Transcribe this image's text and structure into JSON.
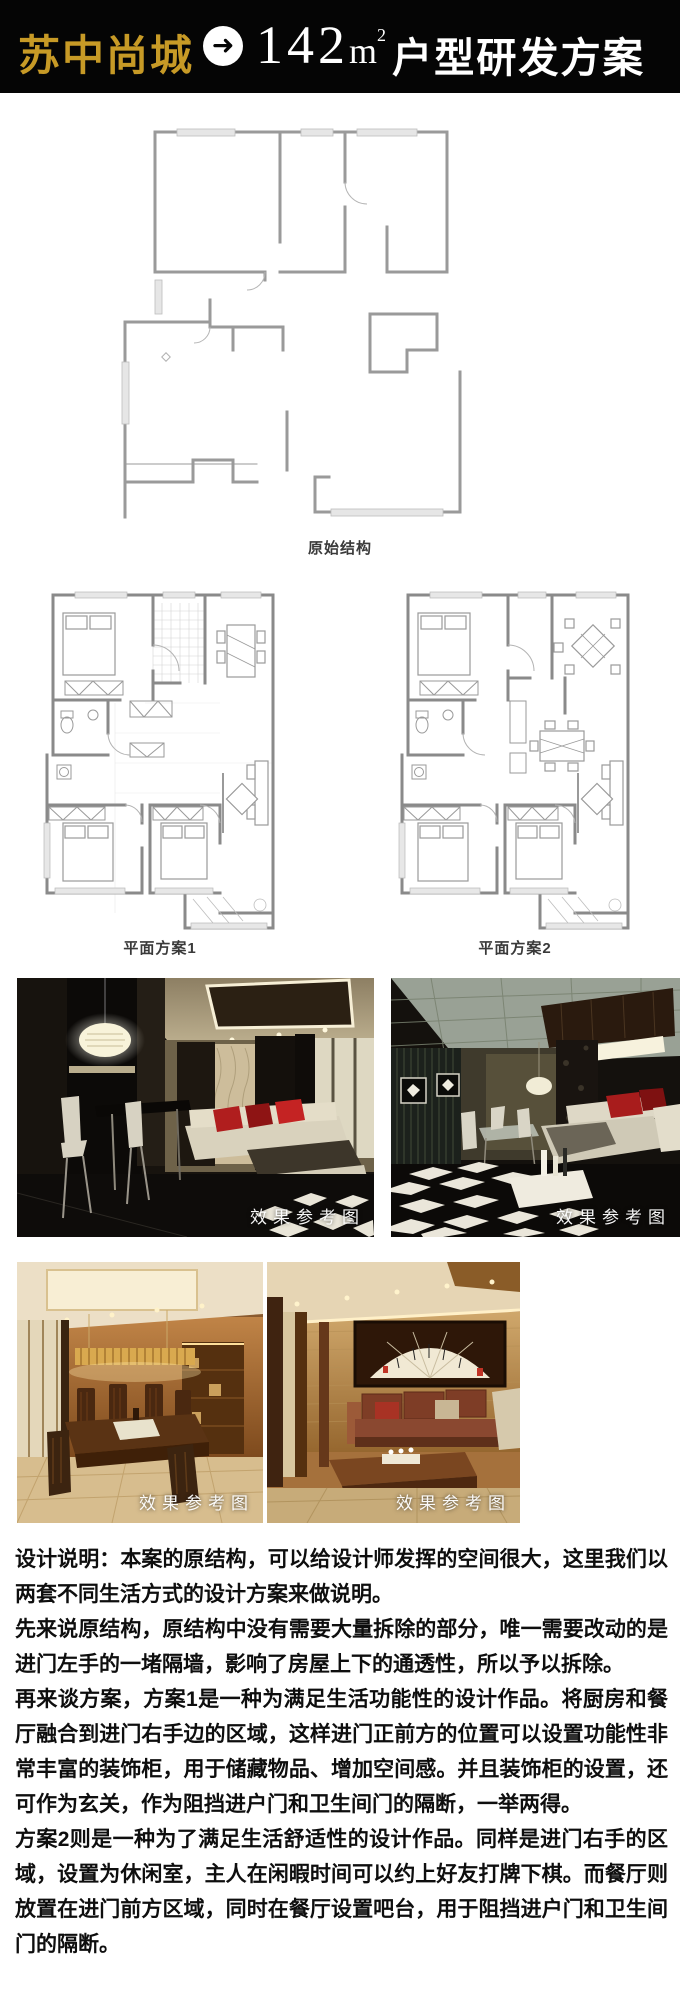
{
  "header": {
    "project_name": "苏中尚城",
    "arrow_icon": "➜",
    "area_value": "142",
    "area_unit": "m",
    "area_sup": "2",
    "title": "户型研发方案",
    "colors": {
      "background": "#050505",
      "gold": "#C79A26",
      "white": "#FFFFFF"
    }
  },
  "floor_plans": {
    "original_label": "原始结构",
    "plan1_label": "平面方案1",
    "plan2_label": "平面方案2"
  },
  "photos": {
    "watermark_label": "效果参考图",
    "accent_red": "#B01E1E",
    "warm_gold": "#C9A24F"
  },
  "design_notes": {
    "paragraphs": [
      "设计说明：本案的原结构，可以给设计师发挥的空间很大，这里我们以两套不同生活方式的设计方案来做说明。",
      "先来说原结构，原结构中没有需要大量拆除的部分，唯一需要改动的是进门左手的一堵隔墙，影响了房屋上下的通透性，所以予以拆除。",
      "再来谈方案，方案1是一种为满足生活功能性的设计作品。将厨房和餐厅融合到进门右手边的区域，这样进门正前方的位置可以设置功能性非常丰富的装饰柜，用于储藏物品、增加空间感。并且装饰柜的设置，还可作为玄关，作为阻挡进户门和卫生间门的隔断，一举两得。",
      "方案2则是一种为了满足生活舒适性的设计作品。同样是进门右手的区域，设置为休闲室，主人在闲暇时间可以约上好友打牌下棋。而餐厅则放置在进门前方区域，同时在餐厅设置吧台，用于阻挡进户门和卫生间门的隔断。"
    ]
  }
}
